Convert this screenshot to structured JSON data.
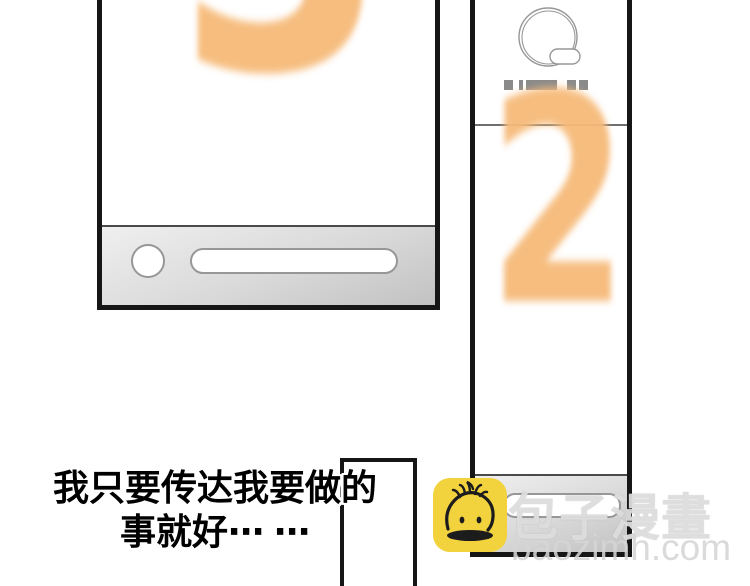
{
  "page": {
    "width": 750,
    "height": 586,
    "background": "#ffffff"
  },
  "panels": {
    "countdown_3": {
      "digit": "3"
    },
    "countdown_2": {
      "digit": "2"
    }
  },
  "speech": {
    "line1": "我只要传达我要做的",
    "line2": "事就好⋯ ⋯"
  },
  "watermark": {
    "brand": "包子漫畫",
    "domain": "baozimh.com"
  },
  "icons": {
    "avatar_sketch": "circle-scribble-avatar-with-pill",
    "redacted_text": "redacted-name-dashes",
    "circle_button": "device-circle-button",
    "pill_slot": "device-pill-slot",
    "logo": "baozi-bun-logo"
  },
  "colors": {
    "digit_orange": "#f6ba79",
    "panel_border": "#161616",
    "bar_light": "#efefef",
    "bar_dark": "#c2c2c2",
    "sketch_gray": "#979797",
    "dash_gray": "#8a8a8a",
    "logo_yellow": "#f2d23d"
  }
}
